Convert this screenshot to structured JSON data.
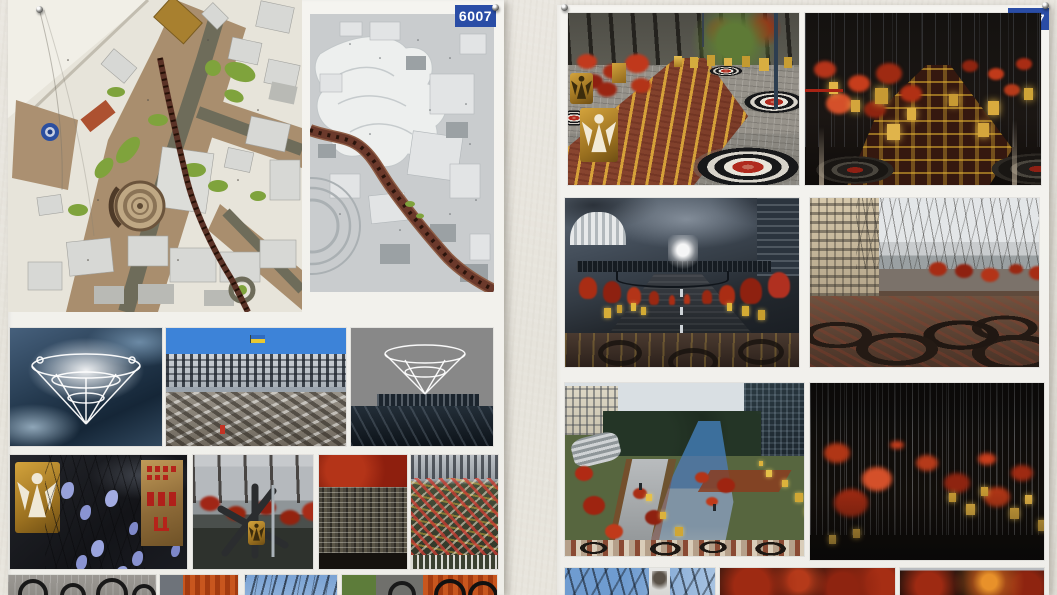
{
  "photo_wall": {
    "scene": "Two architecture-competition presentation boards pinned to a textured white gallery wall",
    "boards": [
      {
        "id": "left",
        "badge": "6007",
        "panels": [
          {
            "name": "site-plan-color",
            "desc": "Colored masterplan of the Maidan Nezalezhnosti area: tan pedestrian surfaces, olive roads, green lawns, blue fountain circle, circular monument plaza, dark-red memorial route"
          },
          {
            "name": "site-plan-grey",
            "desc": "Grey figure-ground plan with terrain contours and a winding dark-red memorial route toward lower right"
          },
          {
            "name": "render-angel-chandelier-sky",
            "desc": "White openwork chandelier of angels glowing against dark storm clouds"
          },
          {
            "name": "photo-maidan-barricades",
            "desc": "Maidan barricades and debris under blue sky with a Ukrainian flag"
          },
          {
            "name": "render-chandelier-over-canopy",
            "desc": "Glowing ring structure above a dark trussed canopy under storm sky"
          },
          {
            "name": "photo-paper-angels-sign",
            "desc": "Golden angel plaque, lavender paper angels on branches and a rusted sign with red Cyrillic lettering"
          },
          {
            "name": "photo-antitank-hedgehog",
            "desc": "Anti-tank hedgehog memorial with golden angel plaque and red trees"
          },
          {
            "name": "photo-memorial-portrait-wall",
            "desc": "Red tree canopy over a wall of small victims' portraits"
          },
          {
            "name": "photo-flower-parapet",
            "desc": "Flowers heaped along a stone parapet below buildings"
          },
          {
            "name": "strip-pavement-rings",
            "desc": "Grey pavement inlaid with dark tyre rings"
          },
          {
            "name": "strip-orange-mosaic",
            "desc": "Orange mosaic paving detail"
          },
          {
            "name": "strip-winter-trees",
            "desc": "Bare winter branches against blue sky"
          },
          {
            "name": "strip-mosaic-rings",
            "desc": "Mosaic paving with dark tyre rings"
          }
        ]
      },
      {
        "id": "right",
        "badge": "6007",
        "panels": [
          {
            "name": "render-plaza-day",
            "desc": "Daytime memorial plaza: golden angel-cutout lanterns, red flowers, brick path with yellow dashes, bullseye targets inlaid in paving"
          },
          {
            "name": "render-plaza-night",
            "desc": "Night plaza with vertical light beams, glowing golden lanterns, red flowers and faint targets"
          },
          {
            "name": "render-street-bridge",
            "desc": "Street toward colonnade and pedestrian bridge crowned by a glowing white wreath, red trees and yellow lanterns lining the wet road"
          },
          {
            "name": "render-street-autumn",
            "desc": "Overcast street with beige building, bare trees, red trees and tyre-ring paving in the foreground"
          },
          {
            "name": "render-park-path",
            "desc": "Elevated view of memorial route: blue wet roadway, stone stairs, red bushes, yellow cube lanterns, mosaic band with tyre rings"
          },
          {
            "name": "render-night-beams",
            "desc": "Night scene of dense thin light beams over glowing red trees and scattered yellow lanterns"
          },
          {
            "name": "strip-banner-sky",
            "desc": "Blue sky, branches and a white portrait banner"
          },
          {
            "name": "strip-red-trees-night",
            "desc": "Red tree canopies in darkness"
          },
          {
            "name": "strip-red-trees-flame",
            "desc": "Red tree canopies with an orange flame glow"
          }
        ]
      }
    ],
    "colors": {
      "wall": "#e8e5dd",
      "board_paper": "#f4f2ec",
      "badge_blue": "#2a4da6",
      "target_red": "#b02a1e",
      "lantern_gold": "#cfa23a",
      "memorial_tree_red": "#a62c14",
      "route_brown": "#6b392b"
    }
  }
}
